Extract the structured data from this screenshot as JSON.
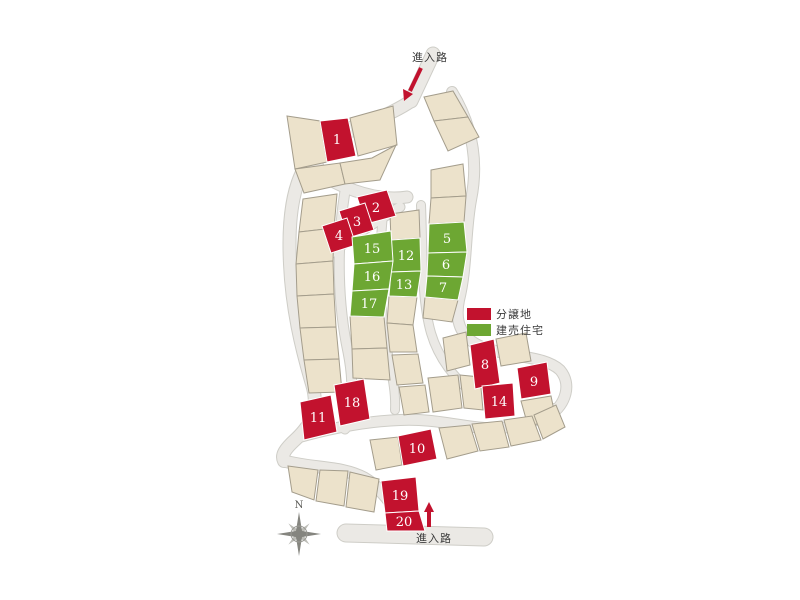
{
  "entrance_top": {
    "label": "進入路"
  },
  "entrance_bottom": {
    "label": "進入路"
  },
  "legend": {
    "items": [
      {
        "label": "分譲地",
        "color": "#c2122e"
      },
      {
        "label": "建売住宅",
        "color": "#6da733"
      }
    ]
  },
  "compass": {
    "north_label": "N"
  },
  "colors": {
    "sale": "#c2122e",
    "built": "#6da733",
    "vacant": "#ece2cb",
    "road": "#ebe9e5",
    "arrow": "#c2122e"
  },
  "lots": [
    {
      "no": "1",
      "type": "sale"
    },
    {
      "no": "2",
      "type": "sale"
    },
    {
      "no": "3",
      "type": "sale"
    },
    {
      "no": "4",
      "type": "sale"
    },
    {
      "no": "5",
      "type": "built"
    },
    {
      "no": "6",
      "type": "built"
    },
    {
      "no": "7",
      "type": "built"
    },
    {
      "no": "8",
      "type": "sale"
    },
    {
      "no": "9",
      "type": "sale"
    },
    {
      "no": "10",
      "type": "sale"
    },
    {
      "no": "11",
      "type": "sale"
    },
    {
      "no": "12",
      "type": "built"
    },
    {
      "no": "13",
      "type": "built"
    },
    {
      "no": "14",
      "type": "sale"
    },
    {
      "no": "15",
      "type": "built"
    },
    {
      "no": "16",
      "type": "built"
    },
    {
      "no": "17",
      "type": "built"
    },
    {
      "no": "18",
      "type": "sale"
    },
    {
      "no": "19",
      "type": "sale"
    },
    {
      "no": "20",
      "type": "sale"
    }
  ]
}
